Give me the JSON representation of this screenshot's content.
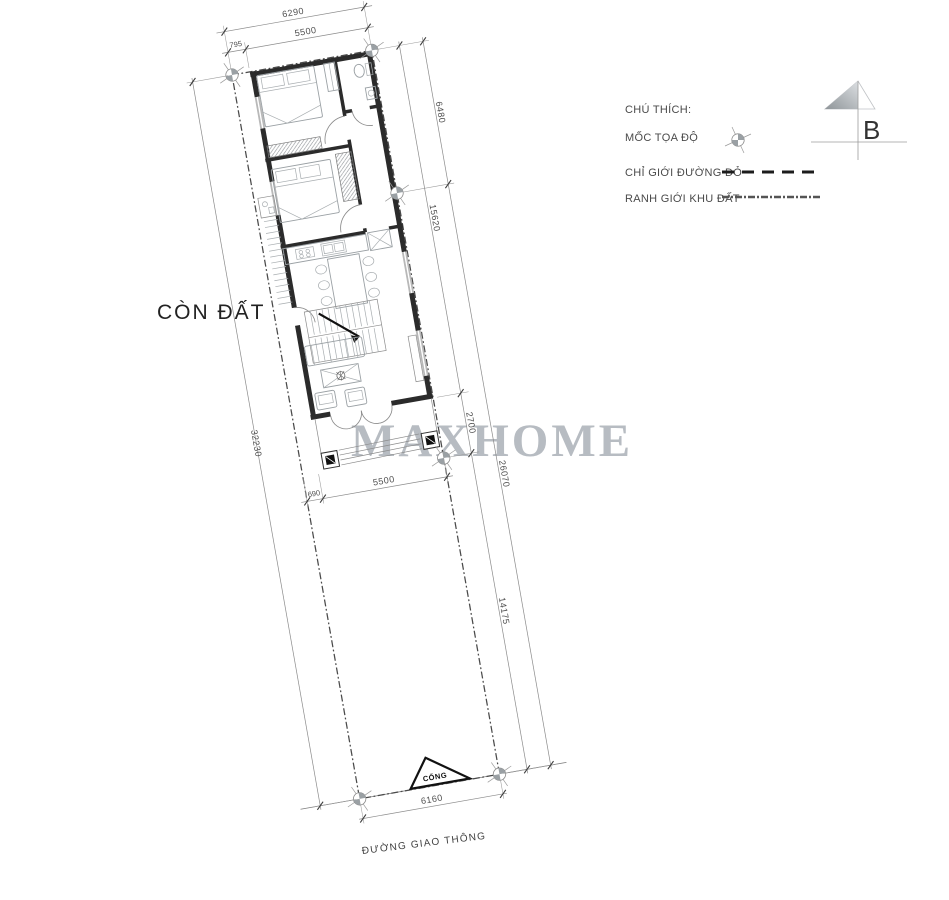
{
  "drawing": {
    "watermark": "MAXHOME",
    "labels": {
      "remaining_land": "CÒN ĐẤT",
      "gate": "CỔNG",
      "road": "ĐƯỜNG GIAO THÔNG"
    },
    "north": {
      "label": "B"
    },
    "legend": {
      "title": "CHÚ THÍCH:",
      "items": [
        {
          "label": "MỐC TỌA ĐỘ",
          "symbol": "survey-marker"
        },
        {
          "label": "CHỈ GIỚI ĐƯỜNG ĐỎ",
          "symbol": "red-boundary-dashed-line"
        },
        {
          "label": "RANH GIỚI KHU ĐẤT",
          "symbol": "site-boundary-dashdot-line"
        }
      ]
    },
    "dimensions": {
      "lot_width_top": "6290",
      "house_width_top": "5500",
      "setback_left_top": "795",
      "right_segment_upper": "6480",
      "house_length": "15620",
      "porch_depth": "2700",
      "right_overall_lower": "26070",
      "front_yard_length": "14175",
      "lot_length_left": "32230",
      "porch_setback_left": "690",
      "porch_width": "5500",
      "gate_width": "6160"
    },
    "colors": {
      "wall": "#2b2b2b",
      "window": "#b8b8b8",
      "furniture_line": "#9aa0a4",
      "dimension_line": "#8b8b8b",
      "dimension_text": "#4f4f4f",
      "boundary": "#4a4a4a",
      "watermark": "#b7bcc2",
      "label_text": "#2f2f2f"
    }
  }
}
